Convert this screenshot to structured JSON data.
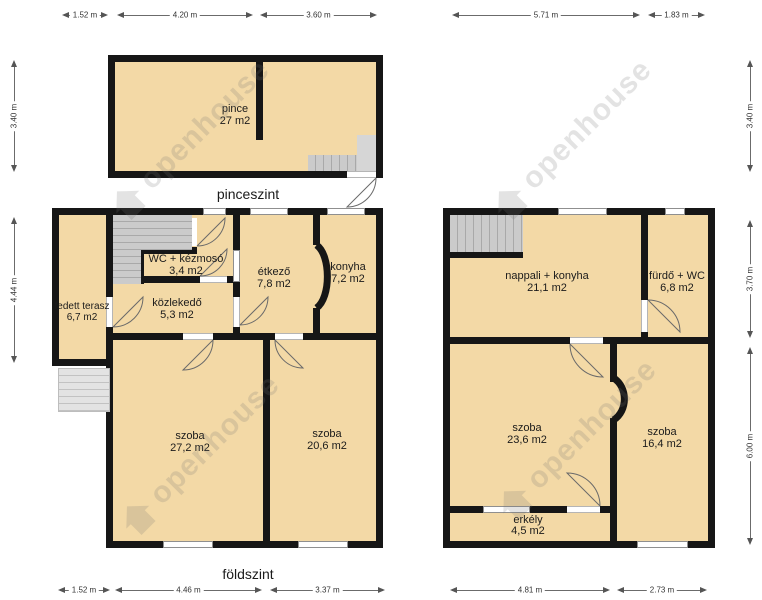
{
  "watermark": {
    "text": "openhouse"
  },
  "titles": {
    "basement": "pinceszint",
    "ground": "földszint"
  },
  "basement": {
    "rooms": {
      "pince": {
        "name": "pince",
        "area": "27 m2"
      }
    }
  },
  "ground": {
    "rooms": {
      "terasz": {
        "name": "fedett terasz",
        "area": "6,7 m2"
      },
      "wc": {
        "name": "WC + kézmosó",
        "area": "3,4 m2"
      },
      "kozlekedo": {
        "name": "közlekedő",
        "area": "5,3 m2"
      },
      "etkezo": {
        "name": "étkező",
        "area": "7,8 m2"
      },
      "konyha": {
        "name": "konyha",
        "area": "7,2 m2"
      },
      "szoba1": {
        "name": "szoba",
        "area": "27,2 m2"
      },
      "szoba2": {
        "name": "szoba",
        "area": "20,6 m2"
      }
    }
  },
  "upper": {
    "rooms": {
      "nappali": {
        "name": "nappali + konyha",
        "area": "21,1 m2"
      },
      "furdo": {
        "name": "fürdő + WC",
        "area": "6,8 m2"
      },
      "szoba1": {
        "name": "szoba",
        "area": "23,6 m2"
      },
      "szoba2": {
        "name": "szoba",
        "area": "16,4 m2"
      },
      "erkely": {
        "name": "erkély",
        "area": "4,5 m2"
      }
    }
  },
  "dimensions": {
    "top": [
      {
        "label": "1.52 m"
      },
      {
        "label": "4.20 m"
      },
      {
        "label": "3.60 m"
      },
      {
        "label": "5.71 m"
      },
      {
        "label": "1.83 m"
      }
    ],
    "left": [
      {
        "label": "3.40 m"
      },
      {
        "label": "4.44 m"
      }
    ],
    "right": [
      {
        "label": "3.40 m"
      },
      {
        "label": "3.70 m"
      },
      {
        "label": "6.00 m"
      }
    ],
    "bottom": [
      {
        "label": "1.52 m"
      },
      {
        "label": "4.46 m"
      },
      {
        "label": "3.37 m"
      },
      {
        "label": "4.81 m"
      },
      {
        "label": "2.73 m"
      }
    ]
  },
  "colors": {
    "room_fill": "#f3d9a6",
    "wall": "#161616",
    "stairs": "#cbcbcb",
    "dimension": "#555555"
  }
}
